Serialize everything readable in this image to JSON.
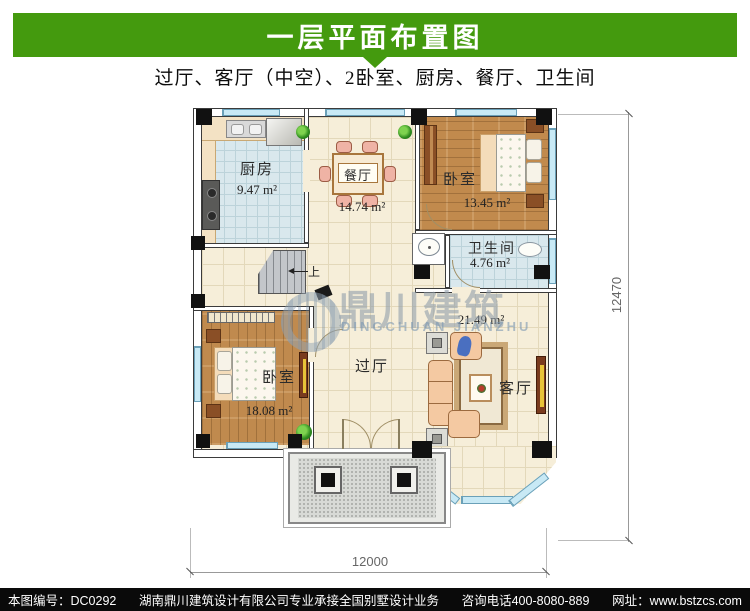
{
  "header": {
    "title": "一层平面布置图",
    "bg_color": "#449a0e",
    "text_color": "#ffffff"
  },
  "subtitle": {
    "text": "过厅、客厅（中空）、2卧室、厨房、餐厅、卫生间"
  },
  "plan": {
    "rooms": {
      "kitchen": {
        "label": "厨房",
        "area": "9.47 m²"
      },
      "dining": {
        "label": "餐厅",
        "area": "14.74 m²"
      },
      "bedroom_top": {
        "label": "卧室",
        "area": "13.45 m²"
      },
      "bathroom": {
        "label": "卫生间",
        "area": "4.76 m²"
      },
      "living": {
        "label": "客厅",
        "area": "21.49 m²"
      },
      "hall": {
        "label": "过厅"
      },
      "bedroom_bottom": {
        "label": "卧室",
        "area": "18.08 m²"
      }
    },
    "stairs_up": "上",
    "dim_right": "12470",
    "dim_bottom": "12000"
  },
  "watermark": {
    "cn": "鼎川建筑",
    "en": "DINGCHUAN JIANZHU"
  },
  "footer": {
    "id": "本图编号：DC0292",
    "company": "湖南鼎川建筑设计有限公司专业承接全国别墅设计业务",
    "phone": "咨询电话400-8080-889",
    "site": "网址：www.bstzcs.com",
    "bg": "#0a0a0a",
    "text_color": "#ffffff"
  },
  "colors": {
    "header_green": "#449a0e",
    "wall": "#3b3b3b",
    "floor_tile": "#f6eed9",
    "floor_blue": "#d9e8ed",
    "wood": "#c18a4d",
    "window_blue": "#c8e9f5",
    "sofa_peach": "#f4c9a2"
  }
}
